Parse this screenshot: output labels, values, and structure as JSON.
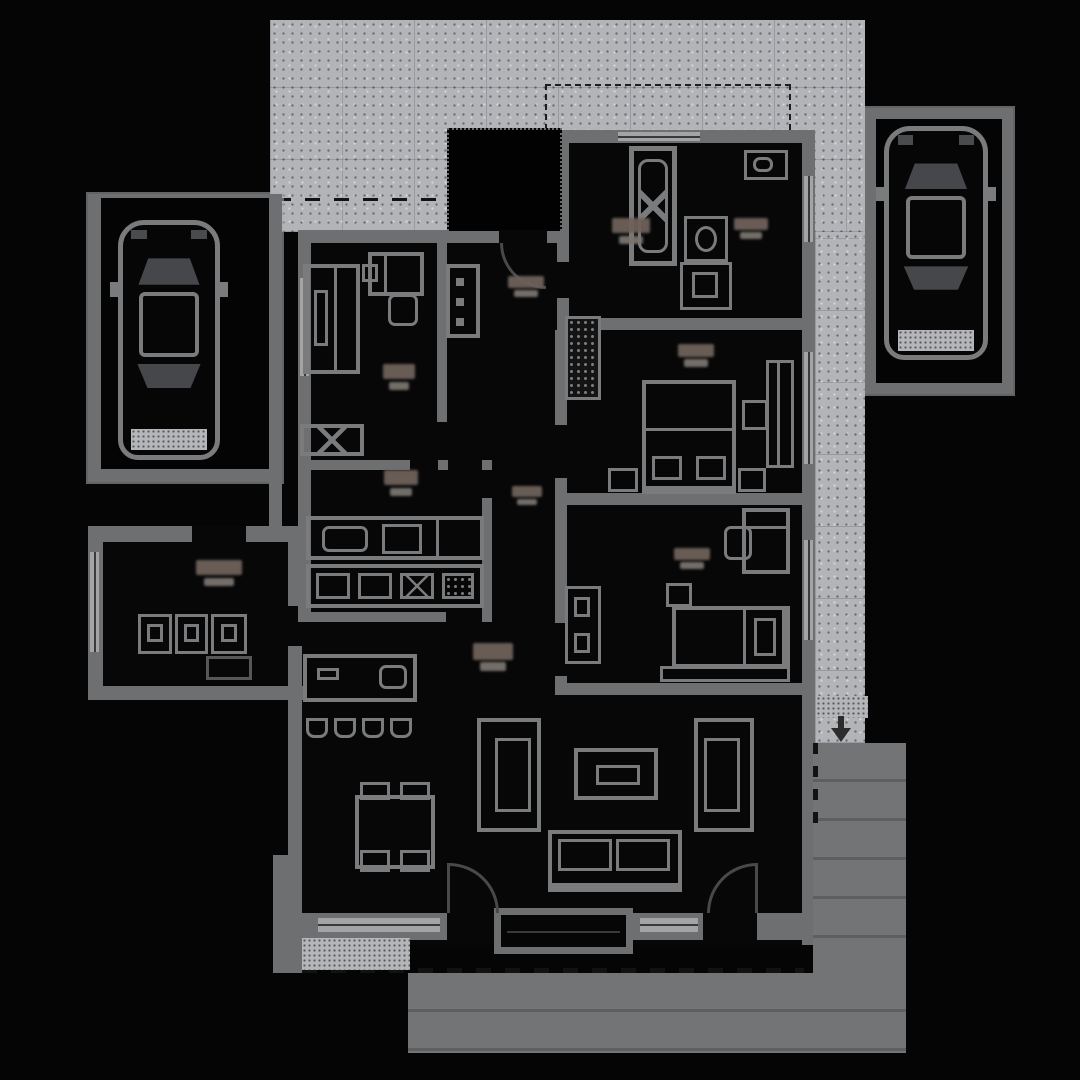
{
  "document": {
    "kind": "architectural floor plan, top view, dark theme",
    "legible_text_present": false
  },
  "colors": {
    "bg": "#050505",
    "wall": "#6e6f71",
    "line": "#7a7b7d",
    "floor": "#070708",
    "paving": "#b3b4b8",
    "terrace": "#737476",
    "plank": "#5e5f61",
    "window": "#a3a4a6",
    "arc": "#49494b",
    "dash": "#121212",
    "label-a": "#6e615a",
    "label-b": "#7a746f",
    "porch": "#020203"
  },
  "site": {
    "areas": [
      "driveway-paving",
      "carport-left",
      "parking-pad-right",
      "entry-porch",
      "wood-deck-terrace",
      "entry-steps-patches",
      "roof-overhang-dashed-outlines"
    ]
  },
  "rooms": [
    "bedroom-1",
    "kitchen",
    "entry-hall",
    "corridor",
    "bathroom",
    "bedroom-2",
    "bedroom-3",
    "living-dining-room",
    "utility-room"
  ],
  "furniture": [
    "car",
    "bed",
    "nightstand",
    "wardrobe",
    "desk",
    "chair",
    "dresser",
    "kitchen-counter",
    "appliances",
    "island-with-stools",
    "dining-table",
    "lounge-chair",
    "coffee-table",
    "sofa",
    "bathtub",
    "shower",
    "toilet",
    "washbasin",
    "washer-dryer-units",
    "sideboard"
  ],
  "labels": {
    "note_blobs": 10
  }
}
